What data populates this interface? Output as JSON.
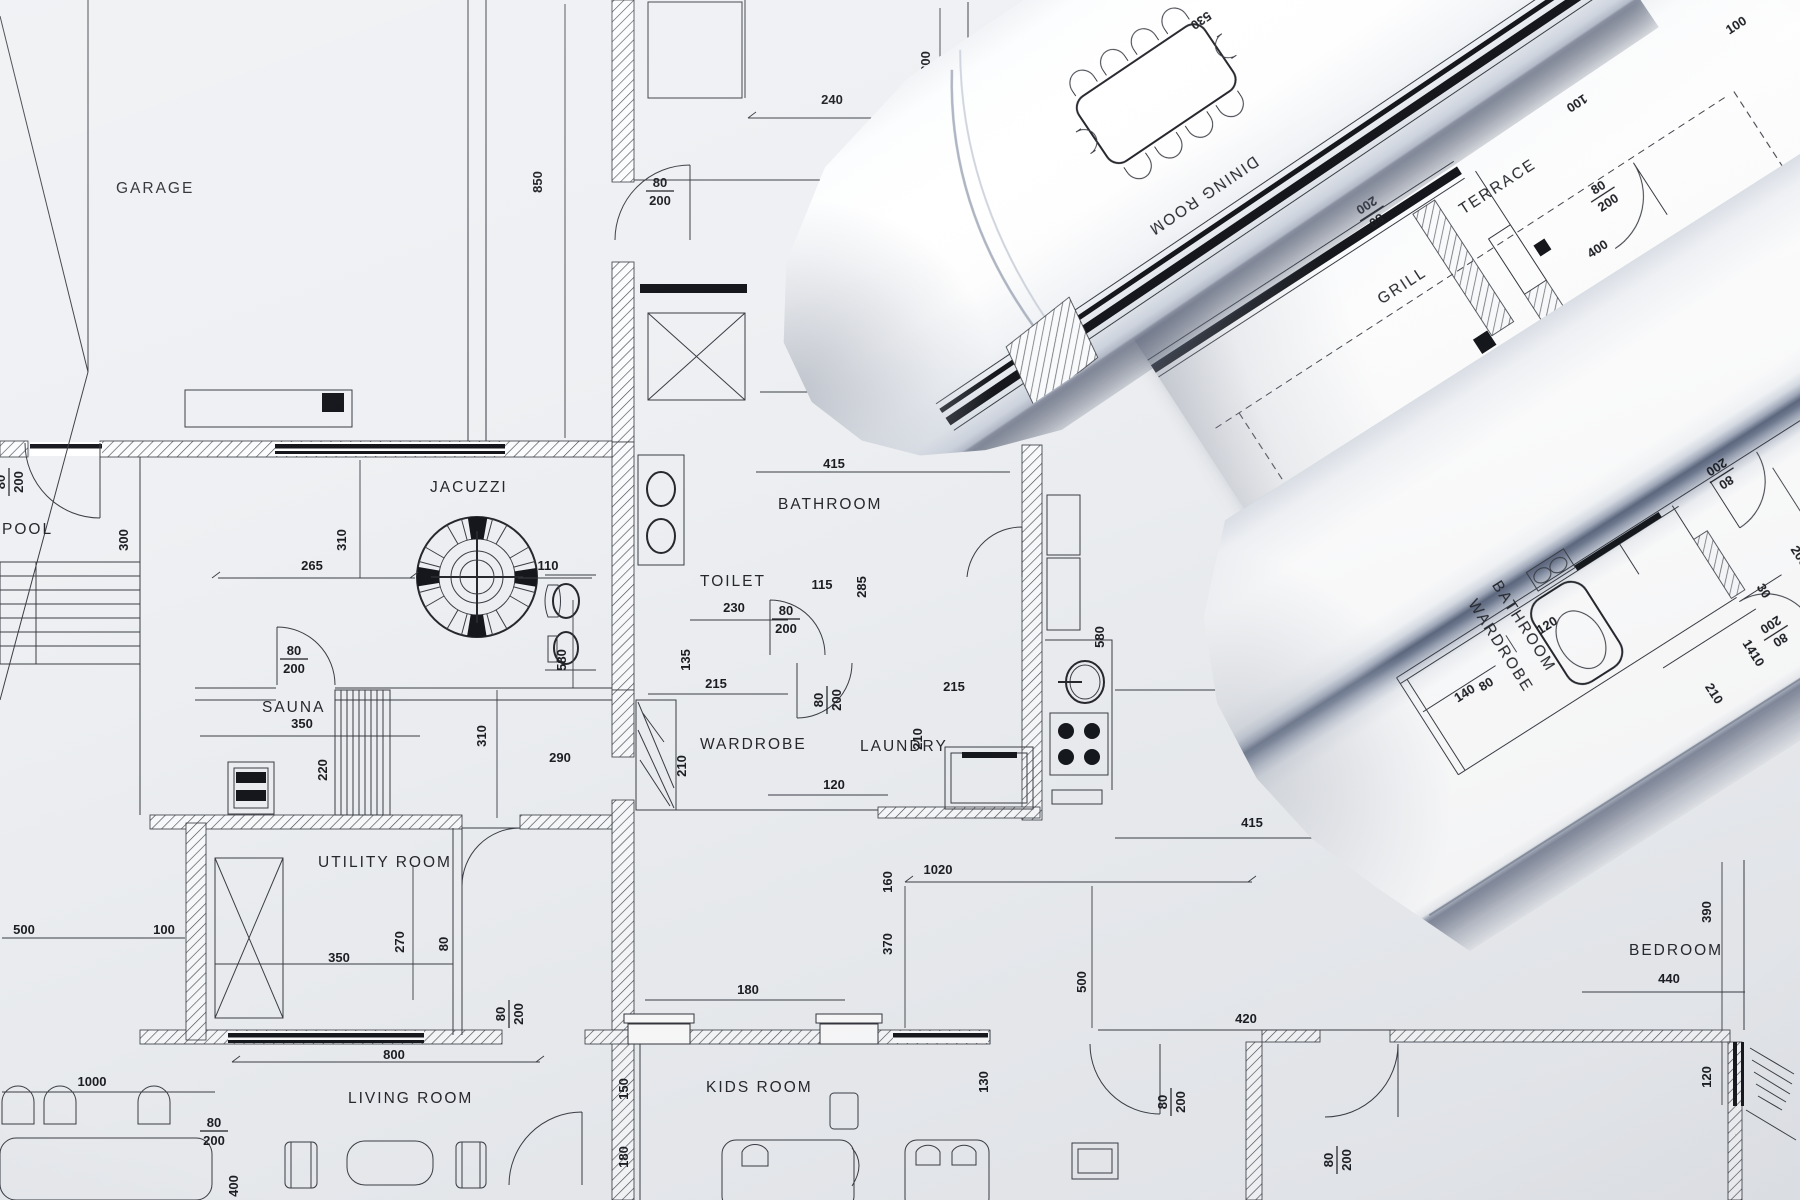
{
  "palette": {
    "paper": "#eef0f3",
    "ink": "#33363c",
    "black_fill": "#15171c",
    "roll_shadow": "#5e6980"
  },
  "base_plan": {
    "rooms": [
      {
        "t": "GARAGE",
        "x": 116,
        "y": 193,
        "c": "r"
      },
      {
        "t": "POOL",
        "x": 2,
        "y": 534,
        "c": "r"
      },
      {
        "t": "JACUZZI",
        "x": 430,
        "y": 492,
        "c": "r"
      },
      {
        "t": "SAUNA",
        "x": 262,
        "y": 712,
        "c": "r"
      },
      {
        "t": "TOILET",
        "x": 700,
        "y": 586,
        "c": "r"
      },
      {
        "t": "BATHROOM",
        "x": 778,
        "y": 509,
        "c": "r"
      },
      {
        "t": "WARDROBE",
        "x": 700,
        "y": 749,
        "c": "r"
      },
      {
        "t": "LAUNDRY",
        "x": 860,
        "y": 751,
        "c": "r"
      },
      {
        "t": "UTILITY  ROOM",
        "x": 318,
        "y": 867,
        "c": "r"
      },
      {
        "t": "LIVING ROOM",
        "x": 348,
        "y": 1103,
        "c": "r"
      },
      {
        "t": "KIDS ROOM",
        "x": 706,
        "y": 1092,
        "c": "r"
      },
      {
        "t": "BEDROOM",
        "x": 1629,
        "y": 955,
        "c": "r"
      }
    ],
    "dims": [
      {
        "t": "850",
        "x": 542,
        "y": 182,
        "r": -90
      },
      {
        "t": "240",
        "x": 832,
        "y": 104
      },
      {
        "t": "300",
        "x": 930,
        "y": 62,
        "r": -90
      },
      {
        "t": "80/200",
        "x": 660,
        "y": 190,
        "f": 1
      },
      {
        "t": "600",
        "x": 818,
        "y": 386
      },
      {
        "t": "300",
        "x": 128,
        "y": 540,
        "r": -90
      },
      {
        "t": "80/200",
        "x": 8,
        "y": 482,
        "r": -90,
        "f": 1
      },
      {
        "t": "310",
        "x": 346,
        "y": 540,
        "r": -90
      },
      {
        "t": "265",
        "x": 312,
        "y": 570
      },
      {
        "t": "110",
        "x": 548,
        "y": 570
      },
      {
        "t": "580",
        "x": 566,
        "y": 660,
        "r": -90
      },
      {
        "t": "350",
        "x": 302,
        "y": 728
      },
      {
        "t": "220",
        "x": 327,
        "y": 770,
        "r": -90
      },
      {
        "t": "80/200",
        "x": 294,
        "y": 658,
        "f": 1
      },
      {
        "t": "310",
        "x": 486,
        "y": 736,
        "r": -90
      },
      {
        "t": "290",
        "x": 560,
        "y": 762
      },
      {
        "t": "230",
        "x": 734,
        "y": 612
      },
      {
        "t": "135",
        "x": 690,
        "y": 660,
        "r": -90
      },
      {
        "t": "415",
        "x": 834,
        "y": 468
      },
      {
        "t": "115",
        "x": 822,
        "y": 589
      },
      {
        "t": "285",
        "x": 866,
        "y": 587,
        "r": -90
      },
      {
        "t": "80/200",
        "x": 786,
        "y": 618,
        "f": 1
      },
      {
        "t": "80/200",
        "x": 826,
        "y": 700,
        "r": -90,
        "f": 1
      },
      {
        "t": "215",
        "x": 954,
        "y": 691
      },
      {
        "t": "215",
        "x": 716,
        "y": 688
      },
      {
        "t": "210",
        "x": 686,
        "y": 766,
        "r": -90
      },
      {
        "t": "210",
        "x": 922,
        "y": 739,
        "r": -90
      },
      {
        "t": "120",
        "x": 834,
        "y": 789
      },
      {
        "t": "160",
        "x": 892,
        "y": 882,
        "r": -90
      },
      {
        "t": "1020",
        "x": 938,
        "y": 874
      },
      {
        "t": "370",
        "x": 892,
        "y": 944,
        "r": -90
      },
      {
        "t": "500",
        "x": 1086,
        "y": 982,
        "r": -90
      },
      {
        "t": "530",
        "x": 1240,
        "y": 688
      },
      {
        "t": "6",
        "x": 1232,
        "y": 628
      },
      {
        "t": "580",
        "x": 1104,
        "y": 637,
        "r": -90
      },
      {
        "t": "415",
        "x": 1252,
        "y": 827
      },
      {
        "t": "270",
        "x": 404,
        "y": 942,
        "r": -90
      },
      {
        "t": "350",
        "x": 339,
        "y": 962
      },
      {
        "t": "80",
        "x": 448,
        "y": 944,
        "r": -90
      },
      {
        "t": "80/200",
        "x": 508,
        "y": 1014,
        "r": -90,
        "f": 1
      },
      {
        "t": "800",
        "x": 394,
        "y": 1059
      },
      {
        "t": "1000",
        "x": 92,
        "y": 1086
      },
      {
        "t": "80/200",
        "x": 214,
        "y": 1130,
        "f": 1
      },
      {
        "t": "400",
        "x": 238,
        "y": 1186,
        "r": -90
      },
      {
        "t": "500",
        "x": 24,
        "y": 934
      },
      {
        "t": "100",
        "x": 164,
        "y": 934
      },
      {
        "t": "180",
        "x": 748,
        "y": 994
      },
      {
        "t": "150",
        "x": 628,
        "y": 1089,
        "r": -90
      },
      {
        "t": "180",
        "x": 628,
        "y": 1157,
        "r": -90
      },
      {
        "t": "130",
        "x": 988,
        "y": 1082,
        "r": -90
      },
      {
        "t": "420",
        "x": 1246,
        "y": 1023
      },
      {
        "t": "80/200",
        "x": 1170,
        "y": 1102,
        "r": -90,
        "f": 1
      },
      {
        "t": "80/200",
        "x": 1336,
        "y": 1160,
        "r": -90,
        "f": 1
      },
      {
        "t": "440",
        "x": 1669,
        "y": 983
      },
      {
        "t": "390",
        "x": 1711,
        "y": 912,
        "r": -90
      },
      {
        "t": "120",
        "x": 1711,
        "y": 1077,
        "r": -90
      }
    ]
  },
  "roll_dining": {
    "labels": [
      {
        "t": "DINING ROOM",
        "x": 478,
        "y": 258,
        "r": 180,
        "c": "r",
        "a": "middle"
      },
      {
        "t": "530",
        "x": 574,
        "y": 112,
        "r": 180
      }
    ]
  },
  "roll_terrace": {
    "labels": [
      {
        "t": "TERRACE",
        "x": 388,
        "y": 86,
        "c": "r",
        "a": "middle"
      },
      {
        "t": "GRILL",
        "x": 254,
        "y": 117,
        "c": "r",
        "a": "middle"
      },
      {
        "t": "400",
        "x": 438,
        "y": 192
      },
      {
        "t": "80/200",
        "x": 472,
        "y": 144,
        "f": 1
      },
      {
        "t": "80/200",
        "x": 268,
        "y": 36,
        "r": 180,
        "f": 1
      },
      {
        "t": "100",
        "x": 676,
        "y": 80
      },
      {
        "t": "100",
        "x": 500,
        "y": 50,
        "r": 180
      },
      {
        "t": "LIV",
        "x": 532,
        "y": 312
      }
    ]
  },
  "roll_bath": {
    "labels": [
      {
        "t": "BATHROOM",
        "x": 560,
        "y": 250,
        "r": 90,
        "c": "r",
        "a": "middle"
      },
      {
        "t": "WARDROBE",
        "x": 530,
        "y": 254,
        "r": 90,
        "c": "r",
        "a": "middle"
      },
      {
        "t": "140",
        "x": 479,
        "y": 279
      },
      {
        "t": "80",
        "x": 502,
        "y": 283
      },
      {
        "t": "120",
        "x": 585,
        "y": 266
      },
      {
        "t": "210",
        "x": 685,
        "y": 409,
        "r": 90
      },
      {
        "t": "1410",
        "x": 740,
        "y": 396,
        "r": 90
      },
      {
        "t": "80/200",
        "x": 813,
        "y": 230,
        "r": 180,
        "f": 1
      },
      {
        "t": "80/200",
        "x": 774,
        "y": 392,
        "r": 180,
        "f": 1
      },
      {
        "t": "200",
        "x": 831,
        "y": 339,
        "r": 90
      },
      {
        "t": "30",
        "x": 782,
        "y": 349,
        "r": 90
      }
    ]
  }
}
